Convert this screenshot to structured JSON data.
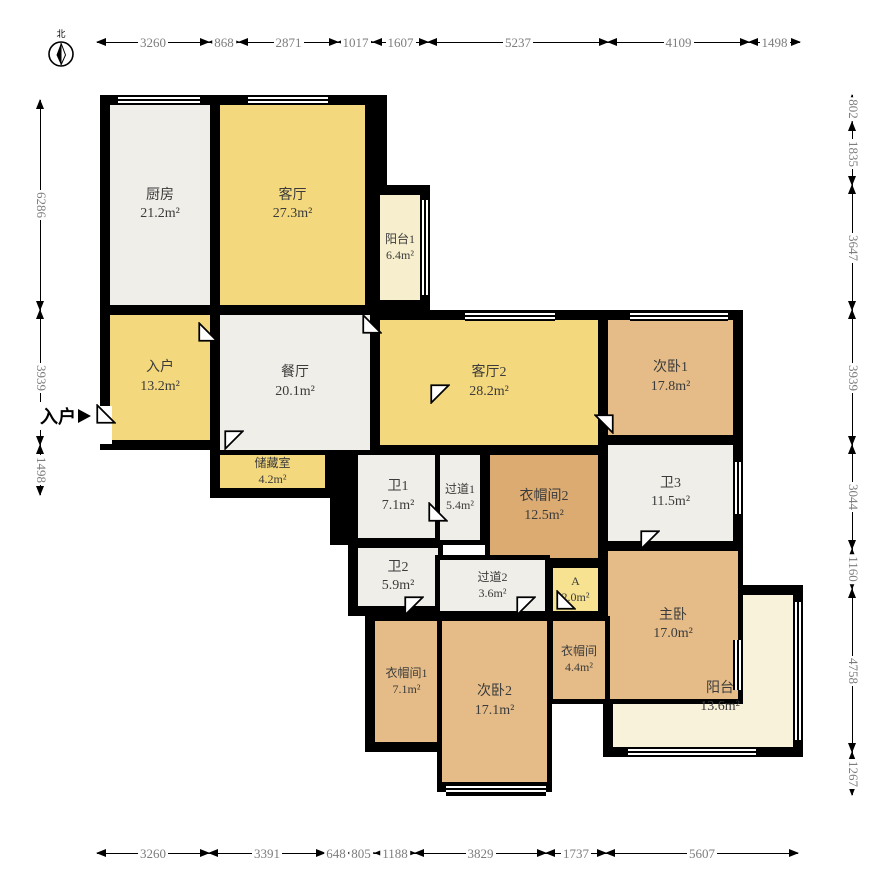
{
  "meta": {
    "kind": "apartment-floor-plan",
    "unit": "mm"
  },
  "compass": {
    "label": "北"
  },
  "entrance": {
    "label": "入户"
  },
  "colors": {
    "living_yellow": "#f4d87e",
    "service_gray": "#f0eee8",
    "bedroom_wood": "#e5bc88",
    "closet_wood": "#dcab72",
    "balcony_cream": "#f6eecd",
    "balcony2_cream": "#f9f2da",
    "highlight_yellow": "#f6e291",
    "wall": "#000000",
    "dim_text": "#7d7d7d"
  },
  "rooms": {
    "kitchen": {
      "name": "厨房",
      "area": "21.2m²"
    },
    "living1": {
      "name": "客厅",
      "area": "27.3m²"
    },
    "balcony1": {
      "name": "阳台1",
      "area": "6.4m²"
    },
    "entry": {
      "name": "入户",
      "area": "13.2m²"
    },
    "dining": {
      "name": "餐厅",
      "area": "20.1m²"
    },
    "living2": {
      "name": "客厅2",
      "area": "28.2m²"
    },
    "bedroom1": {
      "name": "次卧1",
      "area": "17.8m²"
    },
    "storage": {
      "name": "储藏室",
      "area": "4.2m²"
    },
    "bath1": {
      "name": "卫1",
      "area": "7.1m²"
    },
    "corridor1": {
      "name": "过道1",
      "area": "5.4m²"
    },
    "closet2": {
      "name": "衣帽间2",
      "area": "12.5m²"
    },
    "bath3": {
      "name": "卫3",
      "area": "11.5m²"
    },
    "bath2": {
      "name": "卫2",
      "area": "5.9m²"
    },
    "corridor2": {
      "name": "过道2",
      "area": "3.6m²"
    },
    "roomA": {
      "name": "A",
      "area": "2.0m²"
    },
    "master": {
      "name": "主卧",
      "area": "17.0m²"
    },
    "closet1": {
      "name": "衣帽间1",
      "area": "7.1m²"
    },
    "bedroom2": {
      "name": "次卧2",
      "area": "17.1m²"
    },
    "closet3": {
      "name": "衣帽间",
      "area": "4.4m²"
    },
    "balcony2": {
      "name": "阳台",
      "area": "13.6m²"
    }
  },
  "dimensions": {
    "top": [
      "3260",
      "868",
      "2871",
      "1017",
      "1607",
      "5237",
      "4109",
      "1498"
    ],
    "bottom": [
      "3260",
      "3391",
      "648",
      "805",
      "1188",
      "3829",
      "1737",
      "5607"
    ],
    "left": [
      "6286",
      "3939",
      "1498"
    ],
    "right": [
      "802",
      "1835",
      "3647",
      "3939",
      "3044",
      "1160",
      "4758",
      "1267"
    ]
  }
}
